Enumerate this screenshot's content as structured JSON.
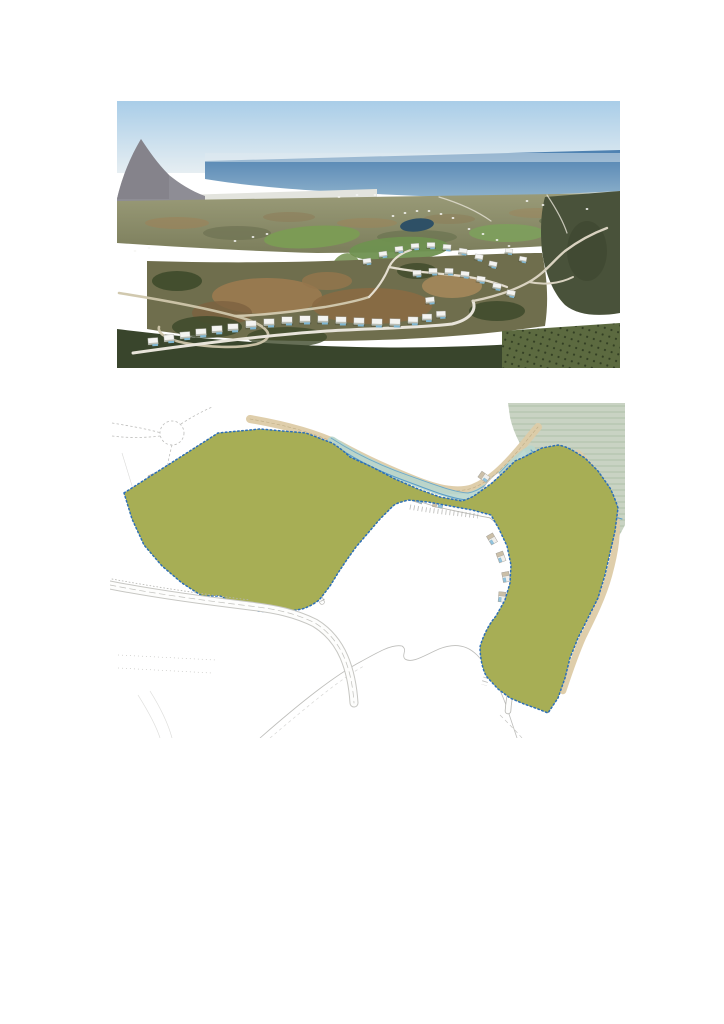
{
  "page": {
    "background": "#ffffff",
    "width": 724,
    "height": 1024,
    "content": "Two untitled figures on a blank white page: an aerial photograph above a development master plan drawing. No visible captions or text."
  },
  "aerial_photo": {
    "description": "Aerial photograph of a hillside villa development with winding roads and golf course, Mediterranean sea and coastal city on the horizon",
    "position": {
      "x": 117,
      "y": 101,
      "width": 503,
      "height": 267
    },
    "villas": [
      [
        250,
        160,
        1,
        -8
      ],
      [
        266,
        153,
        1,
        -8
      ],
      [
        282,
        148,
        1,
        -6
      ],
      [
        298,
        145,
        1,
        -3
      ],
      [
        314,
        144,
        1,
        0
      ],
      [
        330,
        146,
        1,
        4
      ],
      [
        346,
        150,
        1,
        8
      ],
      [
        362,
        156,
        1,
        10
      ],
      [
        376,
        163,
        1,
        12
      ],
      [
        300,
        172,
        1.05,
        -4
      ],
      [
        316,
        170,
        1.05,
        0
      ],
      [
        332,
        170,
        1.05,
        2
      ],
      [
        348,
        173,
        1.05,
        6
      ],
      [
        364,
        178,
        1.05,
        8
      ],
      [
        380,
        185,
        1.05,
        10
      ],
      [
        394,
        192,
        1.05,
        12
      ],
      [
        392,
        150,
        0.9,
        8
      ],
      [
        406,
        158,
        0.9,
        10
      ],
      [
        313,
        199,
        1.1,
        -6
      ],
      [
        36,
        240,
        1.25,
        -4
      ],
      [
        52,
        237,
        1.25,
        -4
      ],
      [
        68,
        234,
        1.25,
        -4
      ],
      [
        84,
        231,
        1.3,
        -3
      ],
      [
        100,
        228,
        1.3,
        -3
      ],
      [
        116,
        226,
        1.3,
        -2
      ],
      [
        134,
        223,
        1.3,
        -2
      ],
      [
        152,
        221,
        1.3,
        -1
      ],
      [
        170,
        219,
        1.3,
        0
      ],
      [
        188,
        218,
        1.3,
        0
      ],
      [
        206,
        218,
        1.3,
        1
      ],
      [
        224,
        219,
        1.3,
        1
      ],
      [
        242,
        220,
        1.3,
        2
      ],
      [
        260,
        221,
        1.3,
        2
      ],
      [
        278,
        221,
        1.3,
        2
      ],
      [
        296,
        219,
        1.25,
        1
      ],
      [
        310,
        216,
        1.2,
        0
      ],
      [
        324,
        213,
        1.15,
        -2
      ]
    ],
    "building_specks": [
      [
        276,
        115
      ],
      [
        288,
        112
      ],
      [
        300,
        110
      ],
      [
        312,
        110
      ],
      [
        324,
        113
      ],
      [
        336,
        117
      ],
      [
        18,
        150
      ],
      [
        32,
        147
      ],
      [
        118,
        140
      ],
      [
        136,
        136
      ],
      [
        150,
        133
      ],
      [
        352,
        128
      ],
      [
        366,
        133
      ],
      [
        380,
        139
      ],
      [
        392,
        145
      ],
      [
        222,
        96
      ],
      [
        240,
        94
      ],
      [
        258,
        94
      ],
      [
        410,
        100
      ],
      [
        426,
        104
      ],
      [
        470,
        108
      ]
    ]
  },
  "site_plan": {
    "description": "Master plan drawing: olive-green residential plots with villas and pools along winding white roads, blue dotted site boundary, stream with riverside vegetation at top right, roundabout, and faint contour lines on unbuilt land",
    "position": {
      "x": 110,
      "y": 403,
      "width": 515,
      "height": 335
    },
    "plots": [
      [
        44,
        74,
        -25
      ],
      [
        62,
        64,
        -25
      ],
      [
        80,
        56,
        -22
      ],
      [
        98,
        49,
        -18
      ],
      [
        116,
        44,
        -12
      ],
      [
        134,
        40,
        -8
      ],
      [
        152,
        38,
        -2
      ],
      [
        170,
        39,
        4
      ],
      [
        188,
        43,
        10
      ],
      [
        205,
        50,
        16
      ],
      [
        48,
        95,
        -25
      ],
      [
        66,
        86,
        -22
      ],
      [
        84,
        78,
        -20
      ],
      [
        102,
        71,
        -16
      ],
      [
        120,
        66,
        -10
      ],
      [
        138,
        62,
        -6
      ],
      [
        156,
        60,
        0
      ],
      [
        174,
        61,
        6
      ],
      [
        192,
        65,
        12
      ],
      [
        210,
        72,
        18
      ],
      [
        226,
        80,
        24
      ],
      [
        252,
        70,
        28
      ],
      [
        270,
        80,
        28
      ],
      [
        288,
        90,
        26
      ],
      [
        308,
        96,
        20
      ],
      [
        328,
        101,
        12
      ],
      [
        70,
        150,
        -60
      ],
      [
        86,
        162,
        -40
      ],
      [
        106,
        172,
        -20
      ],
      [
        126,
        178,
        -8
      ],
      [
        146,
        179,
        0
      ],
      [
        166,
        173,
        12
      ],
      [
        184,
        164,
        24
      ],
      [
        198,
        151,
        38
      ],
      [
        112,
        127,
        -15
      ],
      [
        132,
        117,
        -8
      ],
      [
        152,
        112,
        0
      ],
      [
        172,
        116,
        8
      ],
      [
        188,
        126,
        18
      ],
      [
        160,
        139,
        0
      ],
      [
        136,
        141,
        -5
      ],
      [
        40,
        120,
        -70
      ],
      [
        50,
        142,
        -60
      ],
      [
        424,
        60,
        40
      ],
      [
        440,
        56,
        0
      ],
      [
        456,
        64,
        30
      ],
      [
        468,
        78,
        40
      ],
      [
        400,
        70,
        35
      ],
      [
        418,
        84,
        40
      ],
      [
        434,
        98,
        42
      ],
      [
        448,
        114,
        45
      ],
      [
        459,
        132,
        55
      ],
      [
        468,
        152,
        65
      ],
      [
        472,
        172,
        75
      ],
      [
        470,
        192,
        85
      ],
      [
        464,
        211,
        95
      ],
      [
        374,
        74,
        35
      ],
      [
        390,
        88,
        40
      ],
      [
        404,
        102,
        42
      ],
      [
        416,
        118,
        48
      ],
      [
        426,
        136,
        55
      ],
      [
        382,
        136,
        60
      ],
      [
        391,
        154,
        70
      ],
      [
        396,
        174,
        80
      ],
      [
        392,
        194,
        95
      ],
      [
        416,
        241,
        -40
      ],
      [
        429,
        255,
        -30
      ],
      [
        421,
        271,
        20
      ],
      [
        413,
        285,
        10
      ],
      [
        424,
        297,
        0
      ]
    ]
  },
  "palette": {
    "sky_top": "#a9cde8",
    "sky_horizon": "#e6eef2",
    "sea_deep": "#4d80b0",
    "sea_near": "#8fb2cc",
    "hills_olive": "#7c7e5c",
    "scrub_dark": "#3e4a2b",
    "dirt_tan": "#9b7a50",
    "golf_green": "#7b9c54",
    "villa_white": "#f4f4f1",
    "pool_blue": "#7fb6d2",
    "plan_zone_green": "#a7ae55",
    "plan_boundary_blue": "#2d6fb7",
    "plan_stream_blue": "#5a9dc8",
    "plan_water_band": "#b7d6cd",
    "plan_path_beige": "#ddcba6",
    "plan_vegetation_sage": "#c9d3c3",
    "plan_road_white": "#fdfdfc",
    "plan_contour_gray": "#c6c6c3"
  }
}
